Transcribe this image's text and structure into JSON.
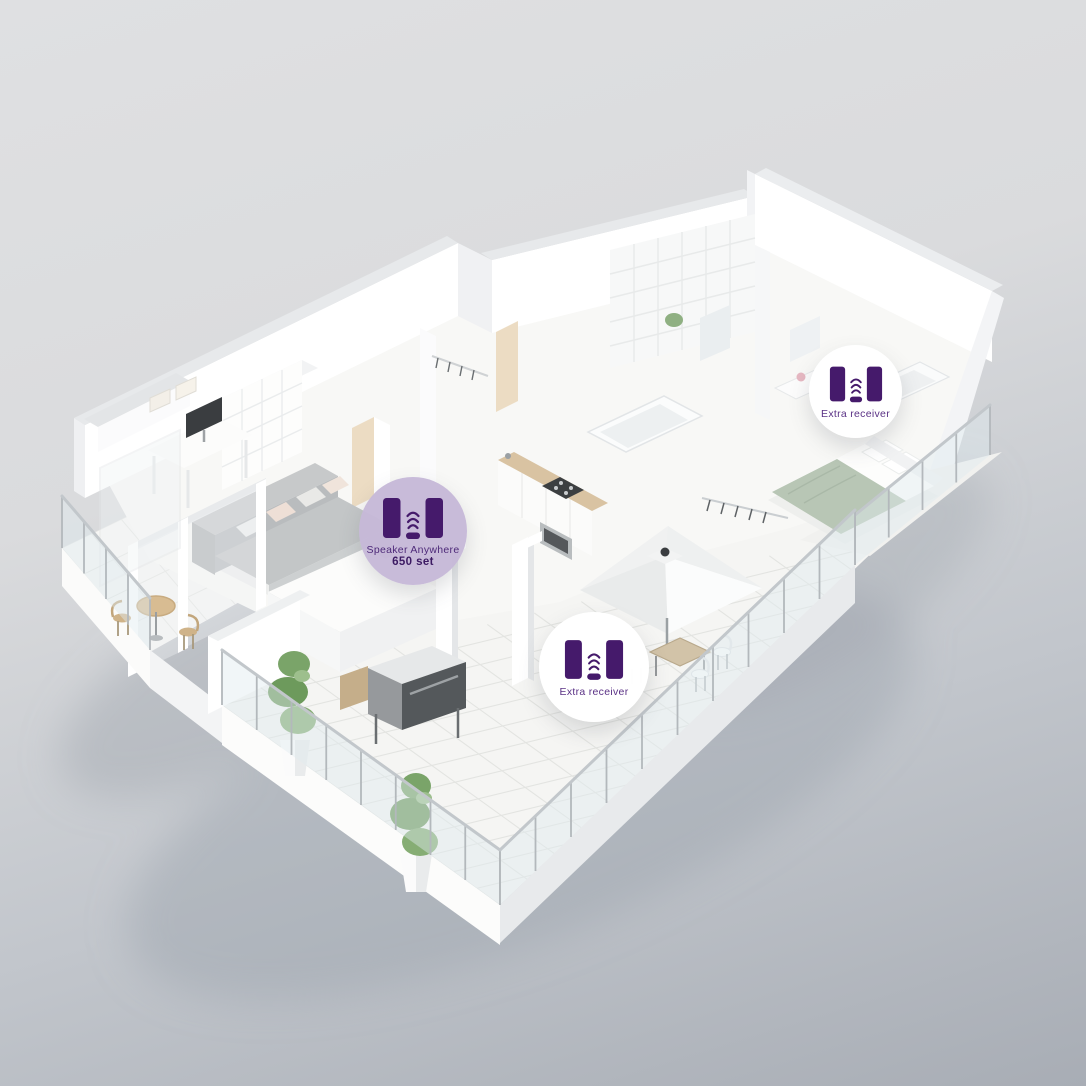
{
  "scene": {
    "type": "isometric-apartment-cutaway-render",
    "background_top": "#dfe0e2",
    "background_bottom": "#a8adb5",
    "accent_purple_dark": "#451a6b",
    "accent_lavender": "#c6b8d7",
    "badge_white": "#ffffff"
  },
  "badges": {
    "main": {
      "line1": "Speaker Anywhere",
      "line2": "650 set",
      "icon": "speaker-set-icon"
    },
    "bedroom": {
      "label": "Extra receiver",
      "icon": "speaker-set-icon"
    },
    "terrace": {
      "label": "Extra receiver",
      "icon": "speaker-set-icon"
    }
  }
}
